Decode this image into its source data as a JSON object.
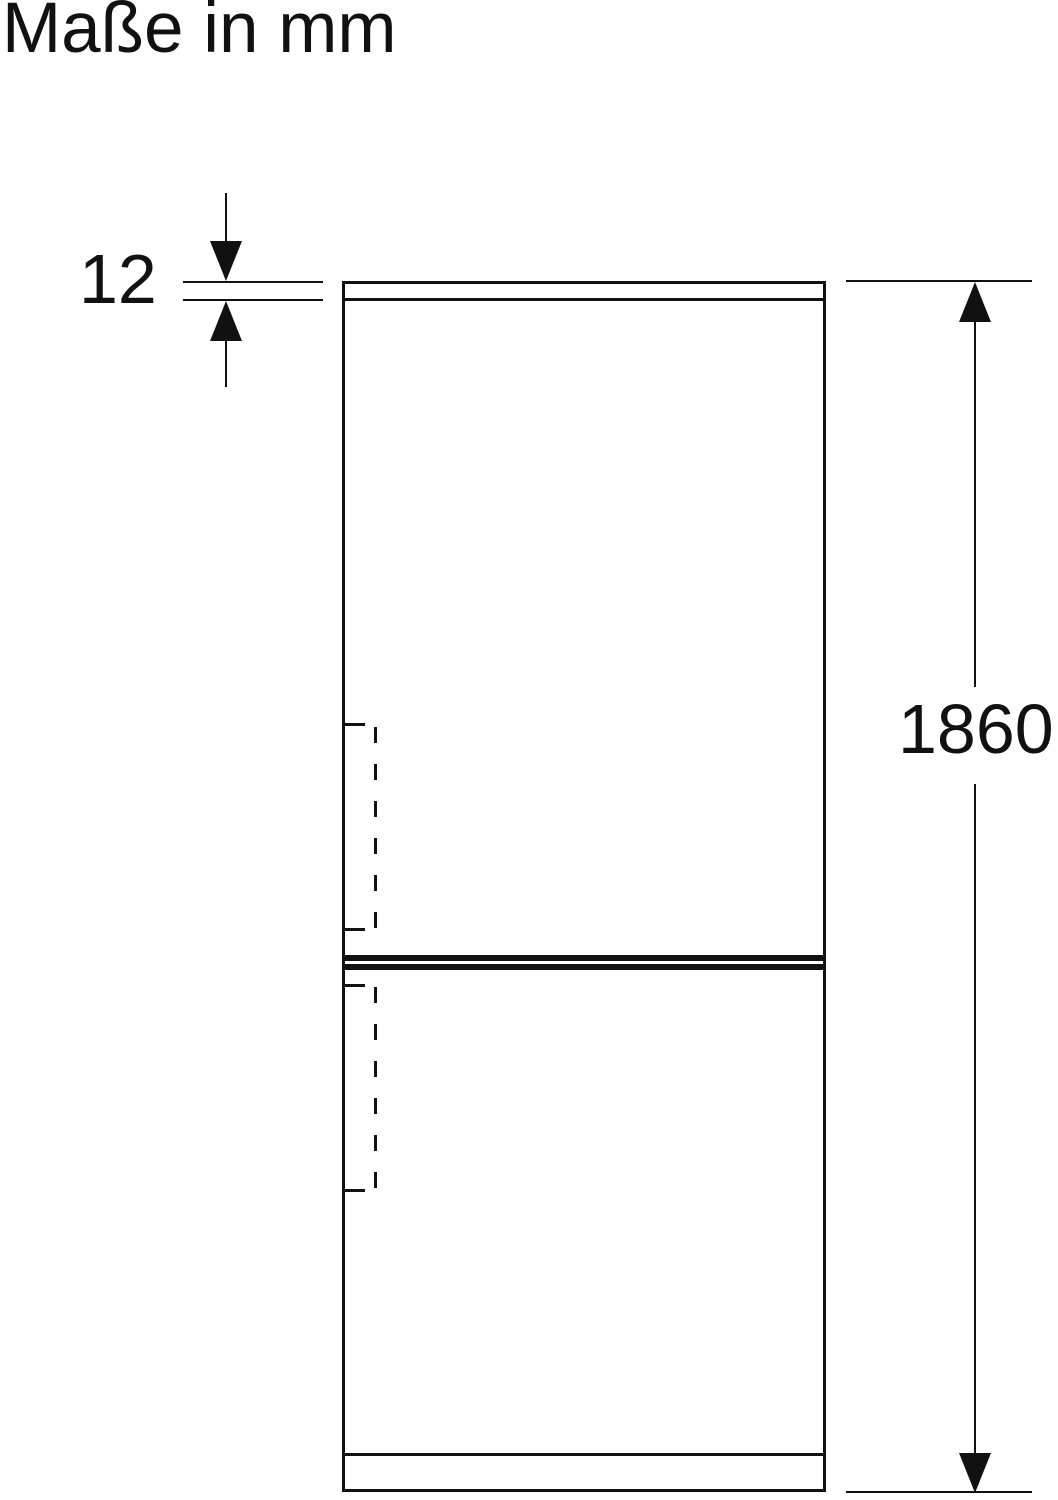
{
  "page": {
    "title": "Maße in mm"
  },
  "theme": {
    "line_color": "#111111",
    "background_color": "#ffffff"
  },
  "figure": {
    "type": "refrigerator-front-outline",
    "unit": "mm",
    "dimensions": [
      {
        "id": "top_panel_thickness",
        "label": "12",
        "value_mm": 12
      },
      {
        "id": "overall_height",
        "label": "1860",
        "value_mm": 1860
      }
    ]
  }
}
